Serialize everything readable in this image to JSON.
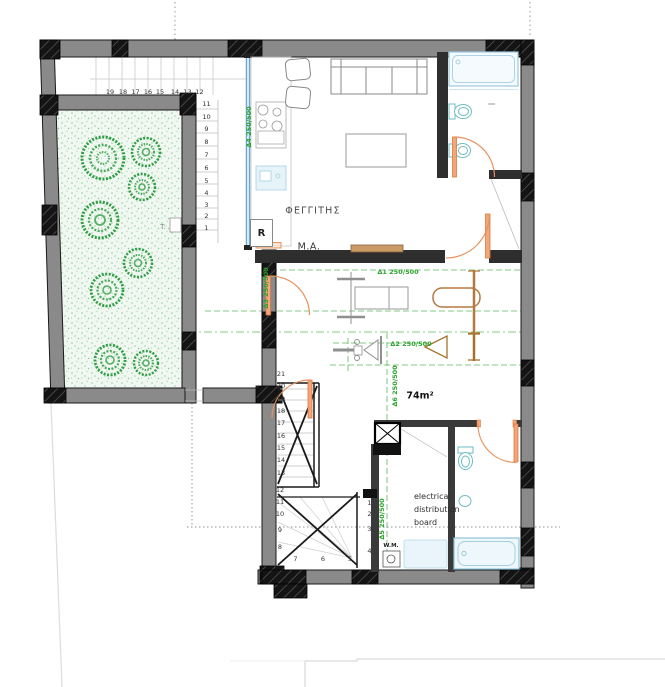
{
  "labels": {
    "skylight": "ΦΕΓΓΙΤΗΣ",
    "room_ma": "Μ.Α.",
    "fridge": "R",
    "area": "74m²",
    "electrical": [
      "electrical",
      "distribution",
      "board"
    ],
    "washing_machine": "W.M.",
    "garden_t": "T."
  },
  "beam_labels": [
    {
      "id": "d4",
      "text": "Δ4 250/500"
    },
    {
      "id": "d1",
      "text": "Δ1 250/500"
    },
    {
      "id": "d3",
      "text": "Δ3 250/500"
    },
    {
      "id": "d2",
      "text": "Δ2 250/500"
    },
    {
      "id": "d6",
      "text": "Δ6 250/500"
    },
    {
      "id": "d5",
      "text": "Δ5 250/500"
    }
  ],
  "stairs": {
    "upper_run": [
      "19",
      "18",
      "17",
      "16",
      "15",
      "14",
      "13",
      "12"
    ],
    "upper_right_run": [
      "11",
      "10",
      "9",
      "8",
      "7",
      "6",
      "5",
      "4",
      "3",
      "2",
      "1"
    ],
    "lower_flight": [
      "21",
      "20",
      "19",
      "18",
      "17",
      "16",
      "15",
      "14",
      "13"
    ],
    "winder_left": [
      "12",
      "11",
      "10",
      "9",
      "8"
    ],
    "winder_bottom": [
      "7",
      "6",
      "5"
    ],
    "winder_right": [
      "1",
      "2",
      "3",
      "4"
    ]
  },
  "colors": {
    "wall_fill": "#8a8a8a",
    "column_fill": "#141414",
    "beam_label_green": "#2ba32b",
    "door_orange": "#e8925f",
    "sanitary_teal": "#6fbdc4",
    "window_blue": "#6aa7d8",
    "tree_green": "#2f9e44"
  }
}
